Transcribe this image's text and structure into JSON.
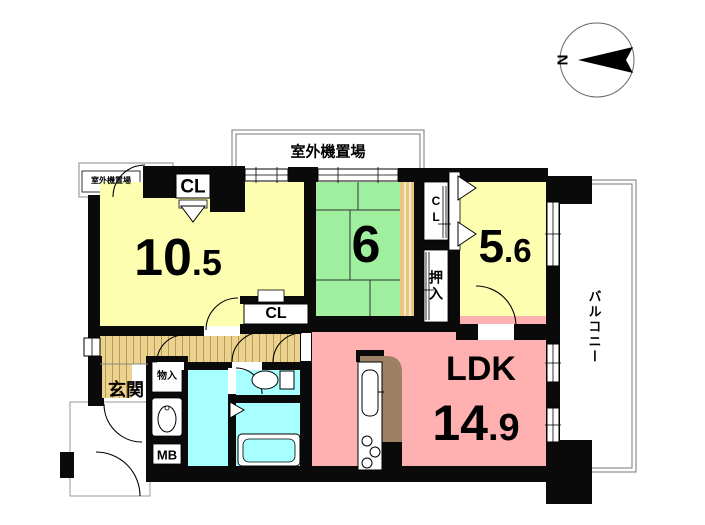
{
  "colors": {
    "room_yellow": "#FEFEB0",
    "room_green": "#9FEF9F",
    "room_pink": "#FFB1B1",
    "wet_cyan": "#A7FFFF",
    "wood_floor": "#EBD28E",
    "wood_grain": "#B99A55",
    "tan_strip": "#E9C77E",
    "kitchen_brown": "#9D8164"
  },
  "compass": {
    "north_label": "N"
  },
  "areas": {
    "outdoor_unit_top": "室外機置場",
    "outdoor_unit_left": "室外機置場",
    "balcony": "バルコニー",
    "entrance": "玄関",
    "storage": "物入",
    "closet_futon": "押入",
    "meter_box": "MB",
    "closet_main": "CL",
    "closet_hall": "CL",
    "closet_side": "CL"
  },
  "rooms": {
    "western1": {
      "size_main": "10",
      "size_frac": ".5"
    },
    "japanese": {
      "size_main": "6",
      "size_frac": ""
    },
    "western2": {
      "size_main": "5",
      "size_frac": ".6"
    },
    "ldk": {
      "label": "LDK",
      "size_main": "14",
      "size_frac": ".9"
    }
  }
}
